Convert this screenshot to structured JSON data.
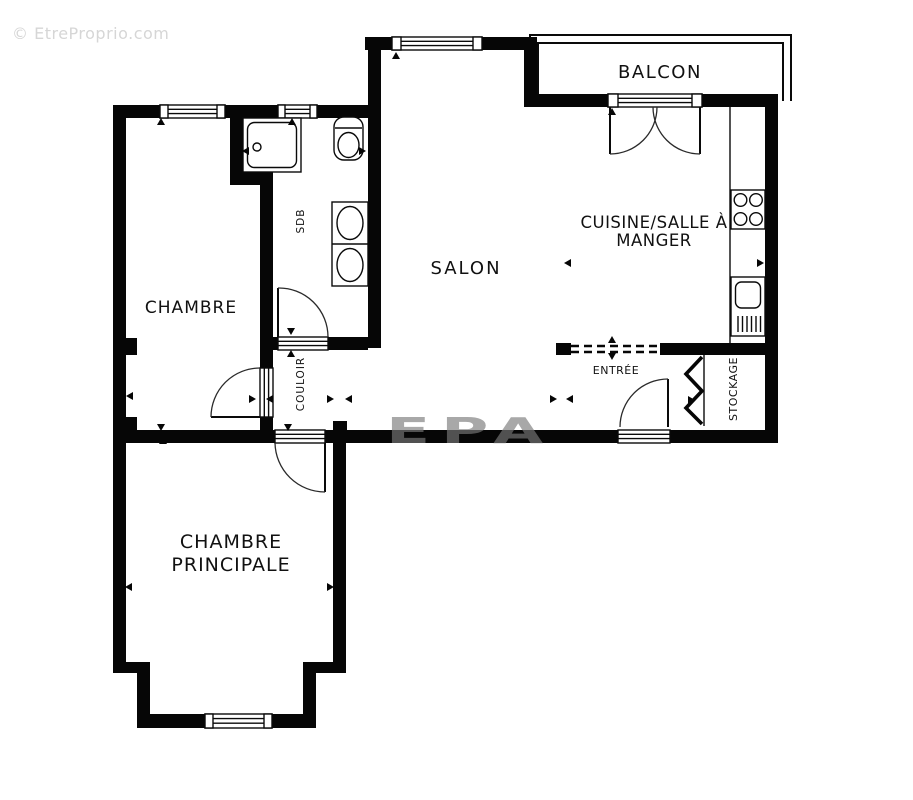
{
  "watermarks": {
    "corner": "© EtreProprio.com",
    "center": "EPA"
  },
  "rooms": {
    "balcon": {
      "label": "BALCON"
    },
    "cuisine": {
      "line1": "CUISINE/SALLE À",
      "line2": "MANGER"
    },
    "salon": {
      "label": "SALON"
    },
    "chambre": {
      "label": "CHAMBRE"
    },
    "chambre_principale": {
      "line1": "CHAMBRE",
      "line2": "PRINCIPALE"
    },
    "sdb": {
      "label": "SDB"
    },
    "couloir": {
      "label": "COULOIR"
    },
    "entree": {
      "label": "ENTRÉE"
    },
    "stockage": {
      "label": "STOCKAGE"
    }
  },
  "colors": {
    "wall": "#060606",
    "background": "#ffffff",
    "watermark_corner": "#d6d6d6",
    "watermark_center": "#7a7a7a"
  }
}
